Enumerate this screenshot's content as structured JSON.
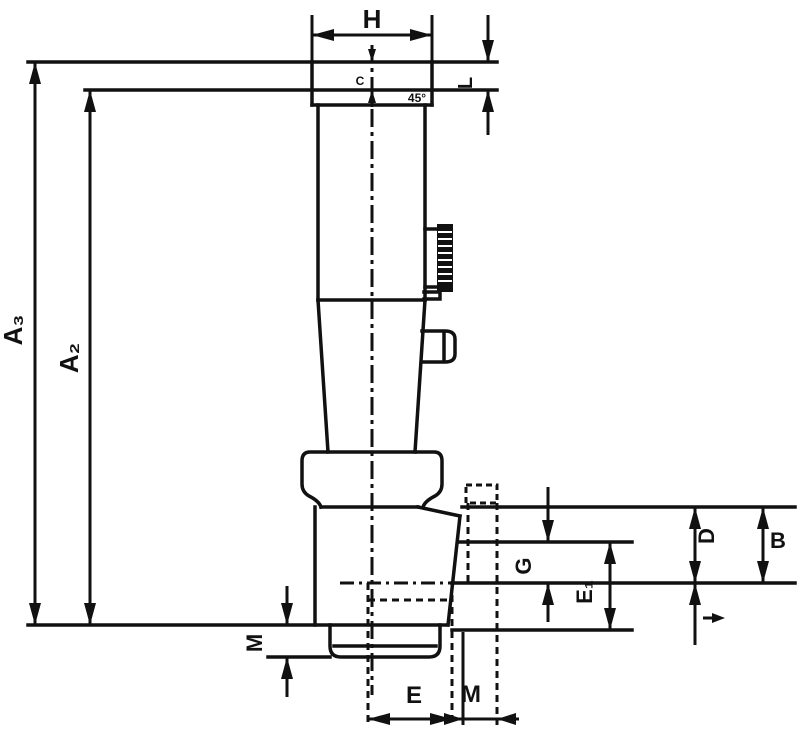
{
  "title": "Technical dimension drawing of a tap holder / quick-change adapter, side view",
  "colors": {
    "line": "#111111",
    "background": "#ffffff"
  },
  "labels": {
    "top_width": "H",
    "head_height": "L",
    "square_depth": "C",
    "chamfer": "45°",
    "overall_length_outer": "A₃",
    "overall_length_inner": "A₂",
    "rim_height": "M",
    "socket_width": "E",
    "square_width": "M",
    "groove_depth": "G",
    "socket_depth": "E₁",
    "recess_depth": "D",
    "body_section": "B"
  },
  "icons": {
    "annotation_arrow": "small-right-arrow-icon",
    "centerline": "dash-dot-centerline",
    "knurl": "knurled-grip-strip"
  }
}
